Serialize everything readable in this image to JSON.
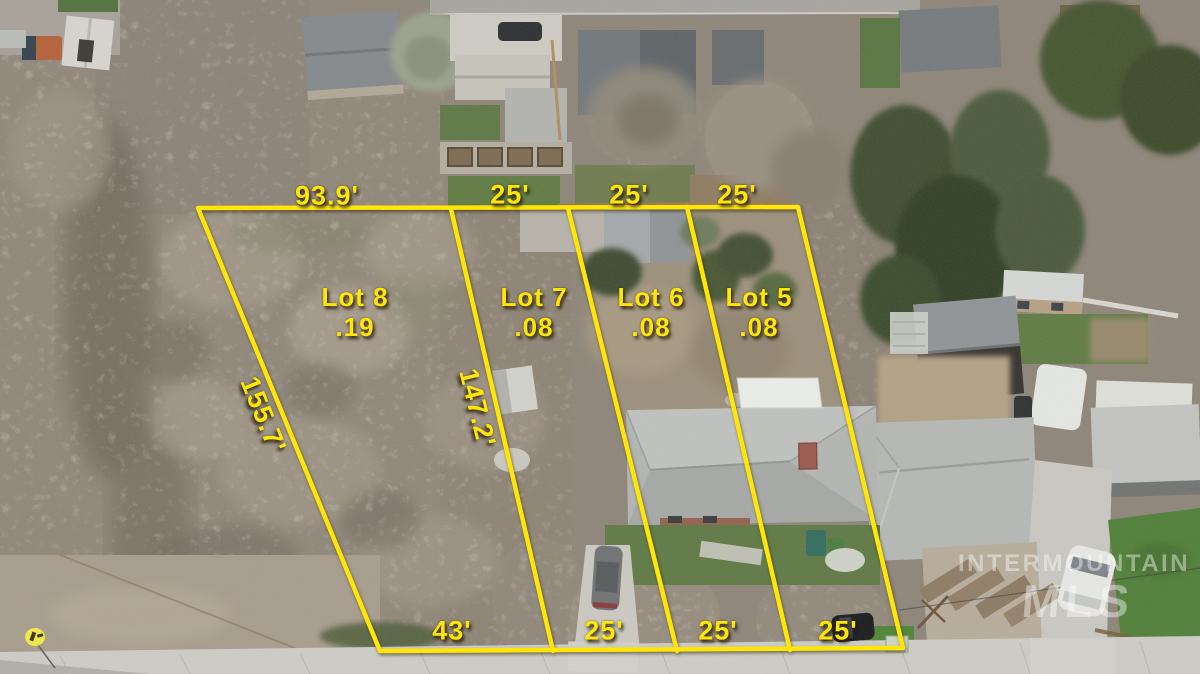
{
  "lots": [
    {
      "name": "Lot 8",
      "acres": ".19"
    },
    {
      "name": "Lot 7",
      "acres": ".08"
    },
    {
      "name": "Lot 6",
      "acres": ".08"
    },
    {
      "name": "Lot 5",
      "acres": ".08"
    }
  ],
  "measurements": {
    "top": [
      "93.9'",
      "25'",
      "25'",
      "25'"
    ],
    "bottom": [
      "43'",
      "25'",
      "25'",
      "25'"
    ],
    "left_side": "155.7'",
    "inner_side": "147.2'"
  },
  "watermark": {
    "line1": "INTERMOUNTAIN",
    "line2": "MLS"
  },
  "colors": {
    "annotation_yellow": "#FFE606",
    "label_shadow": "rgba(40,28,0,0.9)",
    "watermark_white": "rgba(255,255,255,0.42)"
  }
}
